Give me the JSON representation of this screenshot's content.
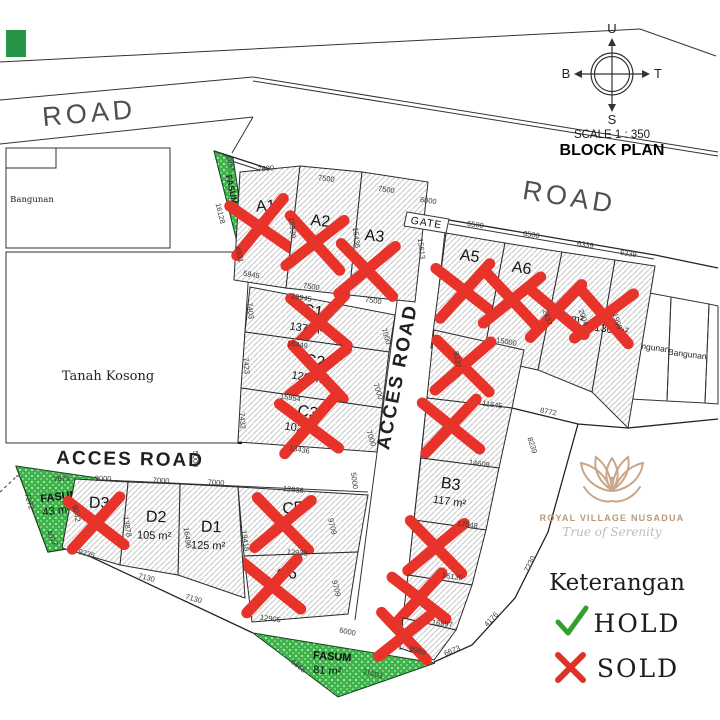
{
  "meta": {
    "scale": "SCALE 1 : 350",
    "title": "BLOCK PLAN"
  },
  "compass": {
    "n": "U",
    "s": "S",
    "w": "B",
    "e": "T"
  },
  "roads": {
    "road_top_left": "ROAD",
    "road_top_right": "ROAD",
    "access_road_horizontal": "ACCES ROAD",
    "access_road_vertical": "ACCES ROAD",
    "gate": "GATE"
  },
  "parcels": {
    "tanah_kosong": "Tanah Kosong",
    "bangunan_left": "Bangunan",
    "bangunan_right_1": "Bangunan",
    "bangunan_right_2": "Bangunan"
  },
  "fasum": [
    {
      "label": "FASUM",
      "area": ""
    },
    {
      "label": "FASUM",
      "area": "43 m²"
    },
    {
      "label": "FASUM",
      "area": "81 m²"
    }
  ],
  "plots": [
    {
      "id": "A1",
      "label": "A1",
      "area": "",
      "status": "sold"
    },
    {
      "id": "A2",
      "label": "A2",
      "area": "",
      "status": "sold"
    },
    {
      "id": "A3",
      "label": "A3",
      "area": "",
      "status": "sold"
    },
    {
      "id": "A5",
      "label": "A5",
      "area": "",
      "status": "sold"
    },
    {
      "id": "A6",
      "label": "A6",
      "area": "",
      "status": "sold"
    },
    {
      "id": "A7",
      "label": "A7",
      "area": "146 m²",
      "status": "sold"
    },
    {
      "id": "A8",
      "label": "A8",
      "area": "136 m²",
      "status": "sold"
    },
    {
      "id": "B1",
      "label": "B1",
      "area": "",
      "status": "sold"
    },
    {
      "id": "B2",
      "label": "B2",
      "area": "",
      "status": "sold"
    },
    {
      "id": "B3",
      "label": "B3",
      "area": "117 m²",
      "status": "available"
    },
    {
      "id": "B5",
      "label": "B5",
      "area": "",
      "status": "sold"
    },
    {
      "id": "B6",
      "label": "B6",
      "area": "",
      "status": "sold"
    },
    {
      "id": "B7",
      "label": "B7",
      "area": "",
      "status": "sold"
    },
    {
      "id": "C1",
      "label": "C1",
      "area": "137 m²",
      "status": "sold"
    },
    {
      "id": "C2",
      "label": "C2",
      "area": "120 m²",
      "status": "sold"
    },
    {
      "id": "C3",
      "label": "C3",
      "area": "102 m²",
      "status": "sold"
    },
    {
      "id": "C5",
      "label": "C5",
      "area": "",
      "status": "sold"
    },
    {
      "id": "C6",
      "label": "C6",
      "area": "",
      "status": "sold"
    },
    {
      "id": "D1",
      "label": "D1",
      "area": "125 m²",
      "status": "available"
    },
    {
      "id": "D2",
      "label": "D2",
      "area": "105 m²",
      "status": "available"
    },
    {
      "id": "D3",
      "label": "D3",
      "area": "",
      "status": "sold"
    }
  ],
  "legend": {
    "title": "Keterangan",
    "hold": "HOLD",
    "sold": "SOLD"
  },
  "logo": {
    "brand": "ROYAL VILLAGE NUSADUA",
    "tagline": "True of Serenity"
  },
  "colors": {
    "sold_x": "#e7332a",
    "hold_check": "#33a02c",
    "fasum_green": "#3cb449",
    "logo_tan": "#c9a687"
  },
  "dims": [
    "7500",
    "7500",
    "7500",
    "6000",
    "6500",
    "6500",
    "6339",
    "6339",
    "15939",
    "15436",
    "15613",
    "4931",
    "5945",
    "7500",
    "7500",
    "20945",
    "16449",
    "15954",
    "13436",
    "7000",
    "7000",
    "7000",
    "7403",
    "7423",
    "7432",
    "3861",
    "16128",
    "15000",
    "11545",
    "14609",
    "17048",
    "16136",
    "16897",
    "9337",
    "8772",
    "8239",
    "7230",
    "4176",
    "6673",
    "8989",
    "11003",
    "6865",
    "6000",
    "12936",
    "9709",
    "12938",
    "9709",
    "12905",
    "19418",
    "9000",
    "7000",
    "7000",
    "5000",
    "13878",
    "16496",
    "9235",
    "7130",
    "7130",
    "7671",
    "7272",
    "4012",
    "9242",
    "5000",
    "2437",
    "2004",
    "1999"
  ]
}
